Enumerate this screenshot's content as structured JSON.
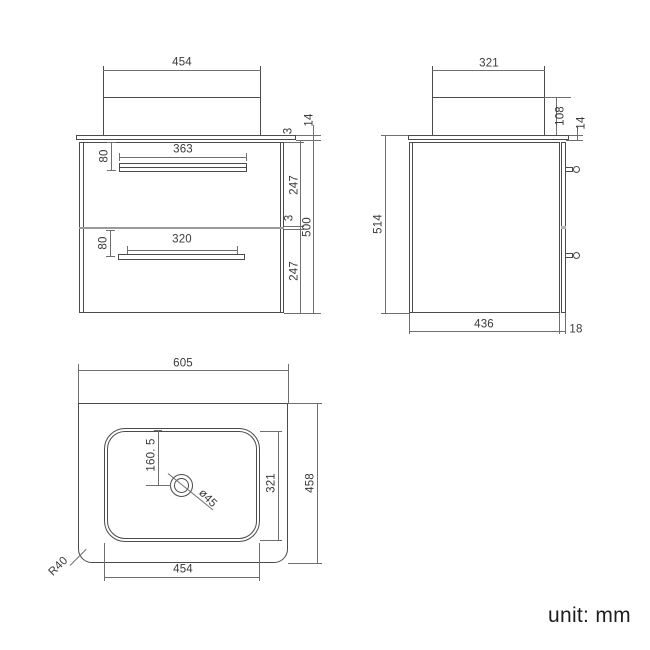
{
  "note": "unit: mm",
  "front": {
    "basin_width": "454",
    "handle_offset_top": "80",
    "handle_width_top": "363",
    "reveal_top": "3",
    "counter_thickness": "14",
    "drawer_height_top": "247",
    "gap_mid": "3",
    "cabinet_height": "500",
    "drawer_height_bottom": "247",
    "handle_offset_bottom": "80",
    "handle_width_bottom": "320"
  },
  "side": {
    "basin_depth": "321",
    "basin_height": "108",
    "counter_thickness": "14",
    "total_height": "514",
    "cabinet_depth": "436",
    "front_projection": "18"
  },
  "top": {
    "counter_width": "605",
    "drain_offset": "160. 5",
    "drain_diameter": "ø45",
    "basin_depth": "321",
    "counter_depth": "458",
    "basin_width": "454",
    "corner_radius": "R40"
  },
  "colors": {
    "line": "#4b4b4b",
    "dim_line": "#6f6f6f",
    "divider": "#9a9a9a",
    "drawer_gap": "#b5b5b5",
    "text": "#3a3a3a",
    "note_text": "#1e1e1e",
    "background": "#ffffff"
  }
}
